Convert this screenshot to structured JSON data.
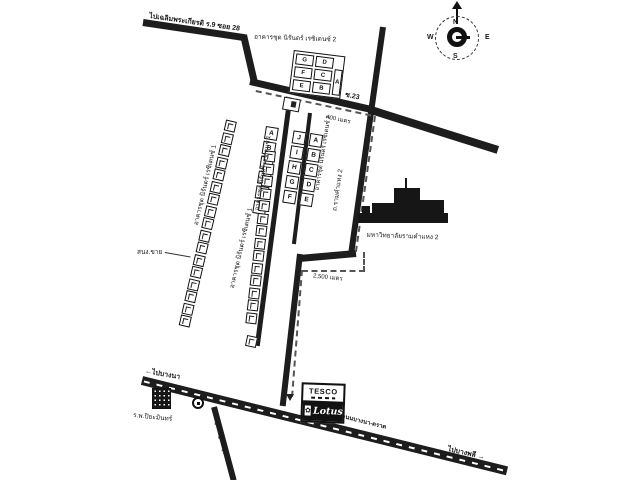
{
  "map": {
    "direction_labels": {
      "to_chaloem": "ไปเฉลิมพระเกียรติ ร.9 ซอย 28",
      "to_bangna": "ไปบางนา",
      "to_bangphli": "ไปบางพลี",
      "arrow_left": "←",
      "arrow_right": "→"
    },
    "roads": {
      "soi23": "ซ.23",
      "ramkhamhaeng": "ถ.รามคำแหง 2",
      "bangna_trat": "ถนนบางนา-ตราด",
      "soi_muban": "ซ.หมู่บ้านเมืองแก้ว"
    },
    "distances": {
      "d400": "400 เมตร",
      "d2500": "2,500 เมตร"
    },
    "places": {
      "condo_2_top": "อาคารชุด นิรันดร์ เรซิเดนซ์ 2",
      "condo_strip1": "อาคารชุด นิรันดร์ เรซิเดนซ์ 1",
      "condo_strip2": "อาคารชุด นิรันดร์ เรซิเดนซ์ 1",
      "condo_col_left": "อาคารชุด นิรันดร์ เรซิเดนซ์ 1",
      "condo_col_right": "อาคารชุด นิรันดร์ เรซิเดนซ์ 2",
      "university": "มหาวิทยาลัยรามคำแหง 2",
      "hospital": "ร.พ.ปิยะมินทร์",
      "sales_office": "สนง.ขาย"
    },
    "tesco": {
      "brand_top": "TESCO",
      "brand_bottom": "Lotus",
      "flower": "✿"
    },
    "compass": {
      "n": "N",
      "e": "E",
      "w": "W",
      "s": "S"
    },
    "buildings": {
      "top_block": {
        "g": "G",
        "d": "D",
        "f": "F",
        "c": "C",
        "e": "E",
        "b": "B",
        "a": "A"
      },
      "col1": [
        "A",
        "B",
        "C",
        "D",
        "E",
        "F"
      ],
      "col2": [
        "J",
        "I",
        "H",
        "G",
        "F"
      ],
      "col3": [
        "A",
        "B",
        "C",
        "D",
        "E"
      ],
      "strip1_count": 17,
      "strip2_count": 14
    },
    "ink_color": "#1d1d1d"
  }
}
